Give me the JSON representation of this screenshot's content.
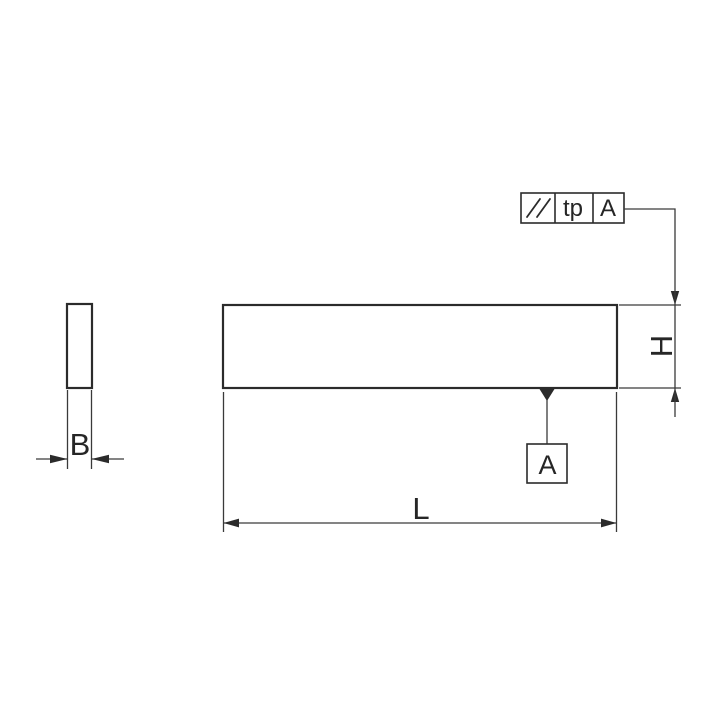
{
  "colors": {
    "background": "#ffffff",
    "line_dark": "#2b2b2b",
    "line_thin": "#3a3a3a",
    "text": "#262626"
  },
  "drawing": {
    "kind": "technical dimension drawing of rectangular parallel block, front view and side view",
    "feature_control_frame": {
      "tolerance_symbol_icon": "parallelism-icon",
      "tolerance_symbol_glyph": "//",
      "tolerance_value": "tp",
      "datum_reference": "A"
    },
    "datum_feature": {
      "label": "A"
    },
    "dimensions": {
      "thickness_label": "B",
      "height_label": "H",
      "length_label": "L"
    }
  }
}
